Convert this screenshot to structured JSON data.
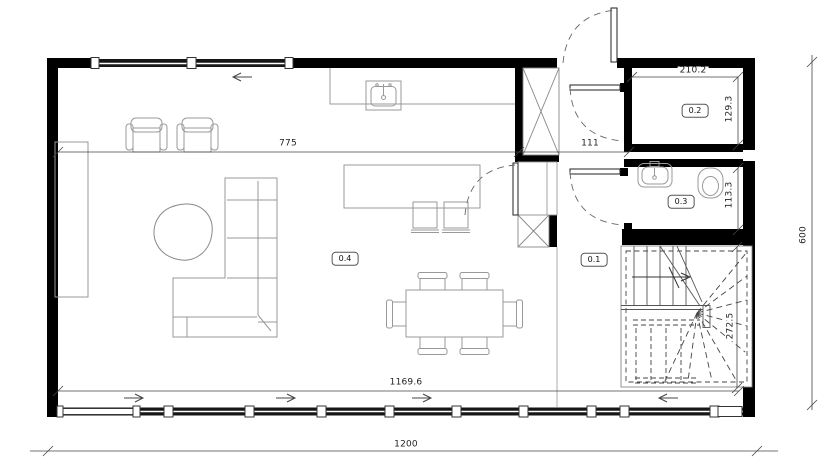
{
  "plan": {
    "rooms": [
      {
        "id": "hall",
        "label": "0.1"
      },
      {
        "id": "storage",
        "label": "0.2"
      },
      {
        "id": "bathroom",
        "label": "0.3"
      },
      {
        "id": "living",
        "label": "0.4"
      }
    ],
    "dimensions": [
      {
        "id": "living-width",
        "label": "775"
      },
      {
        "id": "hall-width",
        "label": "111"
      },
      {
        "id": "room-02-width",
        "label": "210.2"
      },
      {
        "id": "room-02-depth",
        "label": "129.3"
      },
      {
        "id": "room-03-depth",
        "label": "113.3"
      },
      {
        "id": "stair-well-depth",
        "label": "272.5"
      },
      {
        "id": "glazed-wall-width",
        "label": "1169.6"
      },
      {
        "id": "building-width",
        "label": "1200"
      },
      {
        "id": "building-depth",
        "label": "600"
      }
    ],
    "colors": {
      "wall": "#000000",
      "furniture_line": "#999999",
      "dimension_line": "#444444",
      "glazing": "#161616"
    }
  }
}
